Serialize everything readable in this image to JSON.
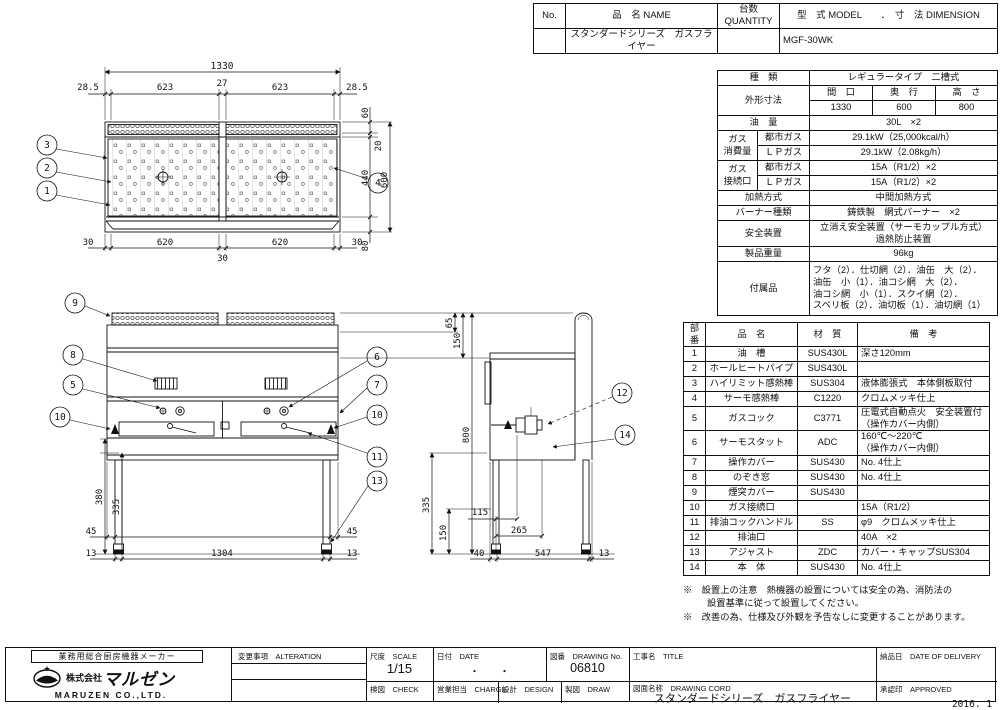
{
  "header_table": {
    "col_no": "No.",
    "col_name": "品　名 NAME",
    "col_qty": "台数 QUANTITY",
    "col_model": "型　式 MODEL　　．　寸　法 DIMENSION",
    "row_name": "スタンダードシリーズ　ガスフライヤー",
    "row_model": "MGF-30WK"
  },
  "spec": {
    "kind_label": "種　類",
    "kind_value": "レギュラータイプ　二槽式",
    "dim_label": "外形寸法",
    "dim_w": "間　口",
    "dim_d": "奥　行",
    "dim_h": "高　さ",
    "dim_w_v": "1330",
    "dim_d_v": "600",
    "dim_h_v": "800",
    "oil_label": "油　量",
    "oil_value": "30L　×2",
    "gas_use_label": "ガス\n消費量",
    "city_gas": "都市ガス",
    "lp_gas": "ＬＰガス",
    "use_city": "29.1kW（25,000kcal/h）",
    "use_lp": "29.1kW（2.08kg/h）",
    "gas_conn_label": "ガス\n接続口",
    "conn_city": "15A（R1/2）×2",
    "conn_lp": "15A（R1/2）×2",
    "heat_label": "加熱方式",
    "heat_value": "中間加熱方式",
    "burner_label": "バーナー種類",
    "burner_value": "鋳鉄製　網式バーナー　×2",
    "safety_label": "安全装置",
    "safety_value": "立消え安全装置（サーモカップル方式）\n過熱防止装置",
    "weight_label": "製品重量",
    "weight_value": "96kg",
    "acc_label": "付属品",
    "acc_value": "フタ（2）．仕切網（2）．油缶　大（2）．\n油缶　小（1）．油コシ網　大（2）．\n油コシ網　小（1）．スクイ網（2）．\nスベリ板（2）．油切板（1）．油切網（1）"
  },
  "parts": {
    "h_no": "部番",
    "h_name": "品　名",
    "h_mat": "材　質",
    "h_note": "備　考",
    "rows": [
      {
        "no": "1",
        "name": "油　槽",
        "mat": "SUS430L",
        "note": "深さ120mm"
      },
      {
        "no": "2",
        "name": "ホールヒートパイプ",
        "mat": "SUS430L",
        "note": ""
      },
      {
        "no": "3",
        "name": "ハイリミット感熱棒",
        "mat": "SUS304",
        "note": "液体膨張式　本体側板取付"
      },
      {
        "no": "4",
        "name": "サーモ感熱棒",
        "mat": "C1220",
        "note": "クロムメッキ仕上"
      },
      {
        "no": "5",
        "name": "ガスコック",
        "mat": "C3771",
        "note": "圧電式自動点火　安全装置付\n（操作カバー内側）"
      },
      {
        "no": "6",
        "name": "サーモスタット",
        "mat": "ADC",
        "note": "160℃～220℃\n（操作カバー内側）"
      },
      {
        "no": "7",
        "name": "操作カバー",
        "mat": "SUS430",
        "note": "No. 4仕上"
      },
      {
        "no": "8",
        "name": "のぞき窓",
        "mat": "SUS430",
        "note": "No. 4仕上"
      },
      {
        "no": "9",
        "name": "煙突カバー",
        "mat": "SUS430",
        "note": ""
      },
      {
        "no": "10",
        "name": "ガス接続口",
        "mat": "",
        "note": "15A（R1/2）"
      },
      {
        "no": "11",
        "name": "排油コックハンドル",
        "mat": "SS",
        "note": "φ9　クロムメッキ仕上"
      },
      {
        "no": "12",
        "name": "排油口",
        "mat": "",
        "note": "40A　×2"
      },
      {
        "no": "13",
        "name": "アジャスト",
        "mat": "ZDC",
        "note": "カバー・キャップSUS304"
      },
      {
        "no": "14",
        "name": "本　体",
        "mat": "SUS430",
        "note": "No. 4仕上"
      }
    ]
  },
  "notes": {
    "n1": "※　設置上の注意　熱機器の設置については安全の為、消防法の",
    "n2": "設置基準に従って設置してください。",
    "n3": "※　改善の為、仕様及び外観を予告なしに変更することがあります。"
  },
  "title_block": {
    "maker_tagline": "業務用総合厨房機器メーカー",
    "company_prefix": "株式会社",
    "company_name": "マルゼン",
    "company_en": "MARUZEN  CO.,LTD.",
    "alteration_label": "変更事項　ALTERATION",
    "scale_label": "尺度　SCALE",
    "scale_value": "1/15",
    "date_label": "日付　DATE",
    "date_value": "・　　・",
    "dwg_no_label": "図番　DRAWING No.",
    "dwg_no_value": "06810",
    "title_label": "工事名　TITLE",
    "delivery_label": "納品日　DATE OF DELIVERY",
    "check_label": "検図　CHECK",
    "design_label": "設計　DESIGN",
    "draw_label": "製図　DRAW",
    "charge_label": "営業担当　CHARGE",
    "dwg_name_label": "図面名称　DRAWING CORD",
    "dwg_name_value": "スタンダードシリーズ　ガスフライヤー",
    "approved_label": "承認印　APPROVED",
    "issue_date": "2016. 1"
  },
  "drawing": {
    "dims": {
      "d1330": "1330",
      "d28p5": "28.5",
      "d623": "623",
      "d27": "27",
      "d30": "30",
      "d620": "620",
      "d60": "60",
      "d20": "20",
      "d440": "440",
      "d600": "600",
      "d80": "80",
      "d65": "65",
      "d150": "150",
      "d800": "800",
      "d380": "380",
      "d335": "335",
      "d45": "45",
      "d13": "13",
      "d1304": "1304",
      "d115": "115",
      "d265": "265",
      "d40": "40",
      "d547": "547"
    },
    "balloons": {
      "n1": "1",
      "n2": "2",
      "n3": "3",
      "n4": "4",
      "n5": "5",
      "n6": "6",
      "n7": "7",
      "n8": "8",
      "n9": "9",
      "n10": "10",
      "n11": "11",
      "n12": "12",
      "n13": "13",
      "n14": "14"
    }
  }
}
